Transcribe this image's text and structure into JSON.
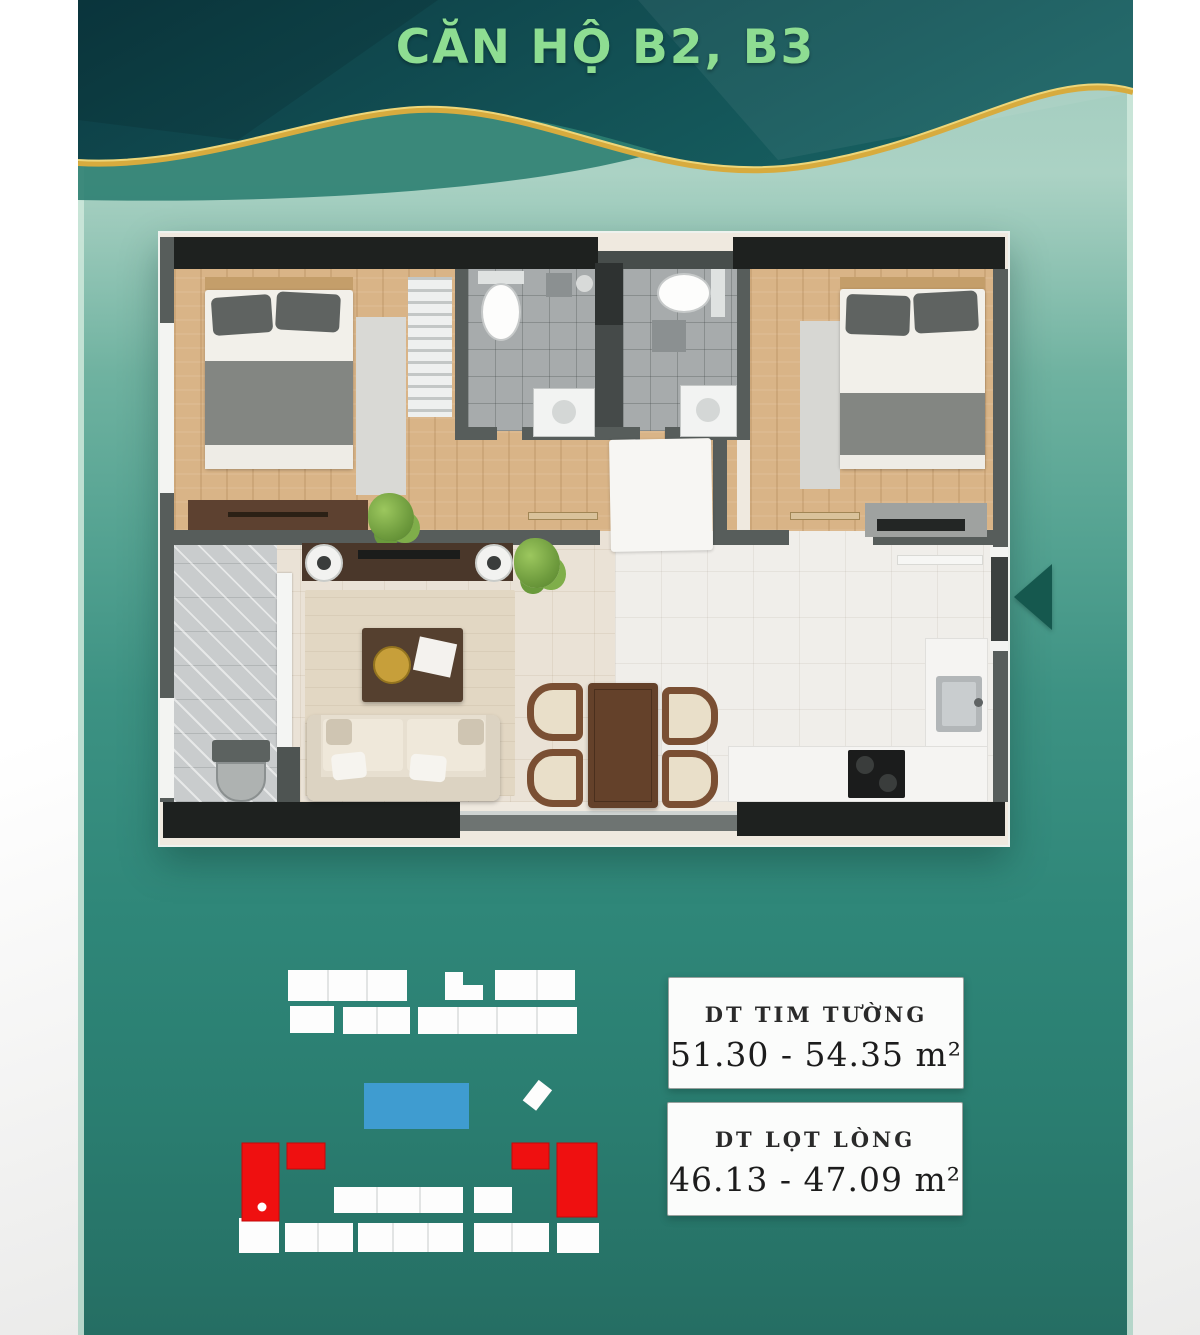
{
  "header": {
    "title": "CĂN HỘ B2, B3"
  },
  "info_boxes": [
    {
      "label": "DT TIM TƯỜNG",
      "value": "51.30 - 54.35 m²"
    },
    {
      "label": "DT LỌT LÒNG",
      "value": "46.13 - 47.09 m²"
    }
  ],
  "icons": {
    "entrance_arrow": "left-pointing-triangle"
  },
  "theme": {
    "bg_margin": "#f7f7f6",
    "edge_mint": "#cfe9dc",
    "header_dark_a": "#0c3b43",
    "header_dark_b": "#176061",
    "header_mid": "#2e7f72",
    "gold": "#d7ab3e",
    "gold_light": "#eed679",
    "title_green": "#8edd92",
    "bg_grad_1": "#abd2c4",
    "bg_grad_2": "#55a392",
    "bg_grad_3": "#2f8779",
    "bg_grad_4": "#256e63",
    "unit_red": "#ef1010",
    "pool_blue": "#3f9cd0",
    "building_white": "#fdfdfd",
    "arrow_teal": "#15584e",
    "wall_dark": "#1e211f",
    "wall_gray": "#575d5b",
    "wood": "#d9b487",
    "tile_gray": "#a7abac",
    "floor_cream": "#eae2d6",
    "floor_kitchen": "#f0eeea",
    "marble": "#c9cccd"
  }
}
